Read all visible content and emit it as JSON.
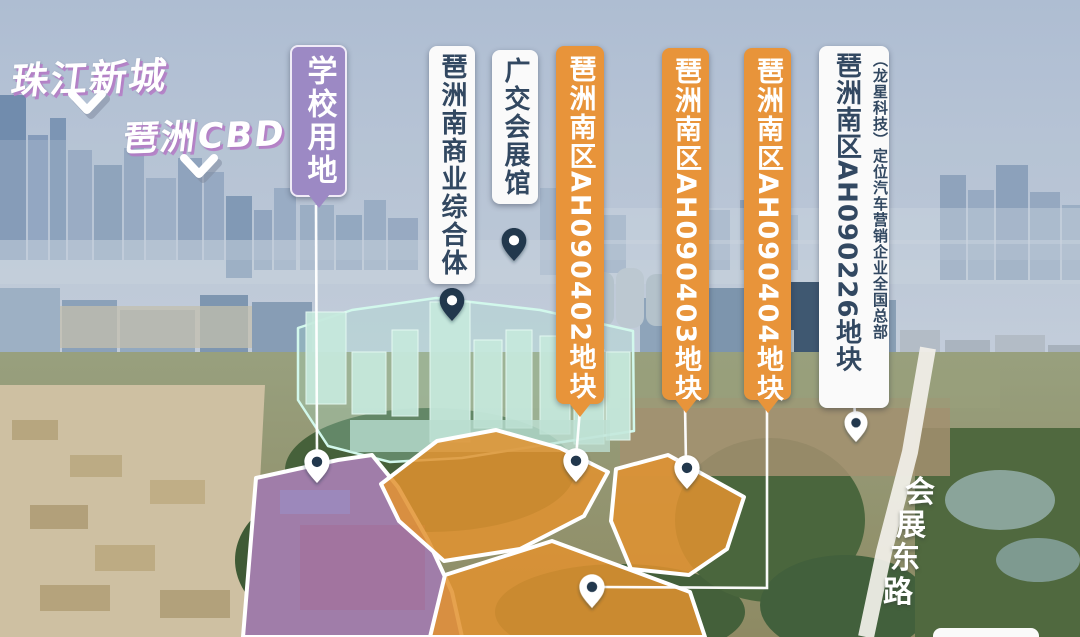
{
  "header": {
    "district_far": "珠江新城",
    "district_near": "琶洲CBD"
  },
  "road": {
    "name": "会展东路",
    "chars": [
      "会",
      "展",
      "东",
      "路"
    ]
  },
  "callouts": [
    {
      "id": "school-land",
      "text": "学校用地",
      "style": "purple",
      "pin": "light"
    },
    {
      "id": "biz-complex",
      "text": "琶洲南商业综合体",
      "style": "white",
      "pin": "dark"
    },
    {
      "id": "expo-hall",
      "text": "广交会展馆",
      "style": "white",
      "pin": "dark"
    },
    {
      "id": "plot-ah090402",
      "text": "琶洲南区AH090402地块",
      "style": "orange",
      "pin": "light"
    },
    {
      "id": "plot-ah090403",
      "text": "琶洲南区AH090403地块",
      "style": "orange",
      "pin": "light"
    },
    {
      "id": "plot-ah090404",
      "text": "琶洲南区AH090404地块",
      "style": "orange",
      "pin": "light"
    },
    {
      "id": "plot-ah090226",
      "text": "琶洲南区AH090226地块",
      "subtext": "（龙星科技）定位汽车营销企业全国总部",
      "style": "white",
      "pin": "light"
    }
  ],
  "colors": {
    "label_orange_bg": "#e8943a",
    "label_purple_bg": "#9c89c4",
    "label_white_bg": "#fafafa",
    "label_dark_text": "#324861",
    "plot_highlight_orange": "#e2922f",
    "plot_highlight_purple": "#a678c0",
    "building_highlight_teal": "#bfeadf",
    "pin_dark": "#24384e",
    "pin_light": "#ffffff",
    "leader_line": "#ffffff"
  }
}
